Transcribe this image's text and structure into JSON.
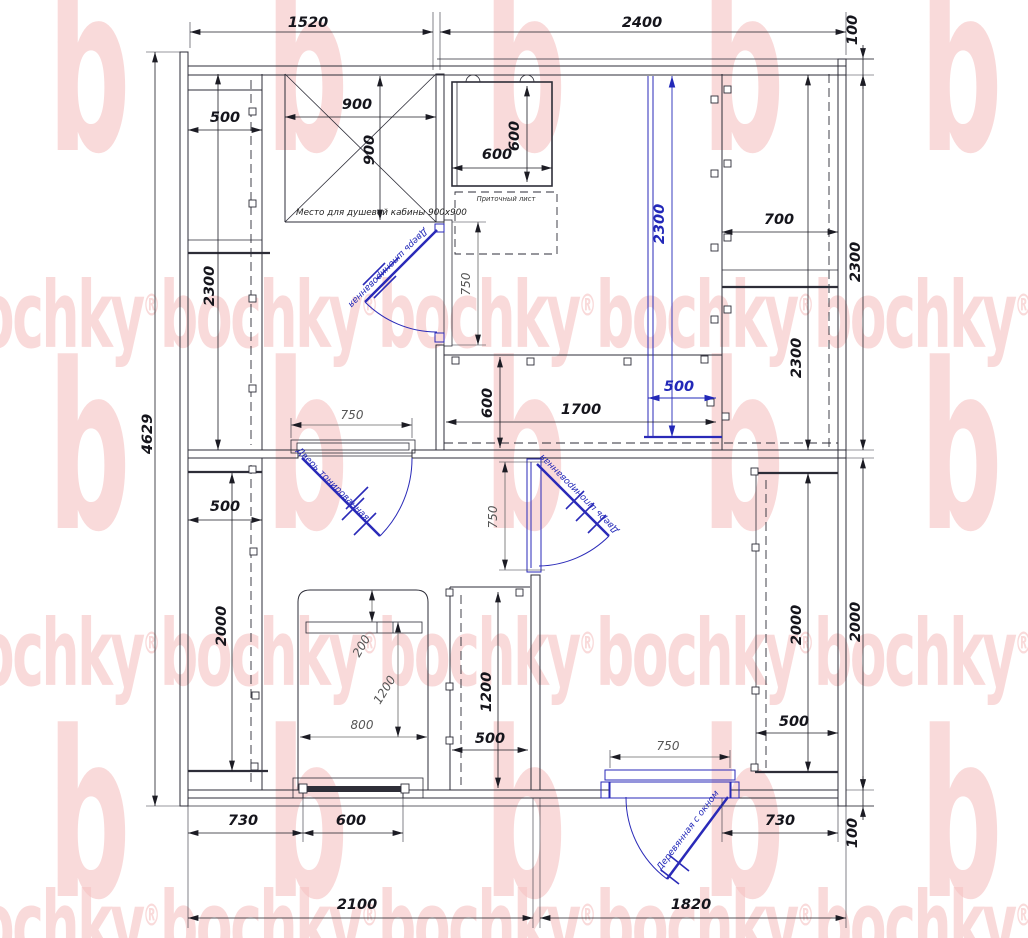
{
  "watermark": {
    "brand": "bochky",
    "letter": "b",
    "reg": "®"
  },
  "notes": {
    "shower": "Место для душевой кабины 900х900",
    "vent": "Приточный лист"
  },
  "doors": {
    "top": "Дверь шпонированная",
    "tinted": "Дверь тонированная",
    "mid": "Дверь шпонированная",
    "entry": "Деревянная с окном"
  },
  "dims": {
    "top_left": "1520",
    "top_right": "2400",
    "top_thk": "100",
    "left_total": "4629",
    "right_up": "2300",
    "right_low": "2000",
    "bot_thk": "100",
    "wash_bench_w": "500",
    "wash_bench_l": "2300",
    "shower_w": "900",
    "shower_d": "900",
    "door_top_w": "750",
    "door_tinted_w": "750",
    "door_mid_w": "750",
    "door_entry_w": "750",
    "stove_w": "600",
    "stove_d": "600",
    "shelf_d": "700",
    "shelf_l": "2300",
    "shelf_up_w": "500",
    "steam_l": "2300",
    "bench_l": "1700",
    "bench_d": "600",
    "rest_bench_w": "500",
    "rest_bench_l": "2000",
    "bed_head": "200",
    "bed_l": "1200",
    "bed_w": "800",
    "closet_l": "1200",
    "closet_w": "500",
    "hall_closet_l": "2000",
    "hall_closet_d": "500",
    "win_off": "730",
    "win_w": "600",
    "bot_left": "2100",
    "door_off": "730",
    "bot_right": "1820"
  }
}
